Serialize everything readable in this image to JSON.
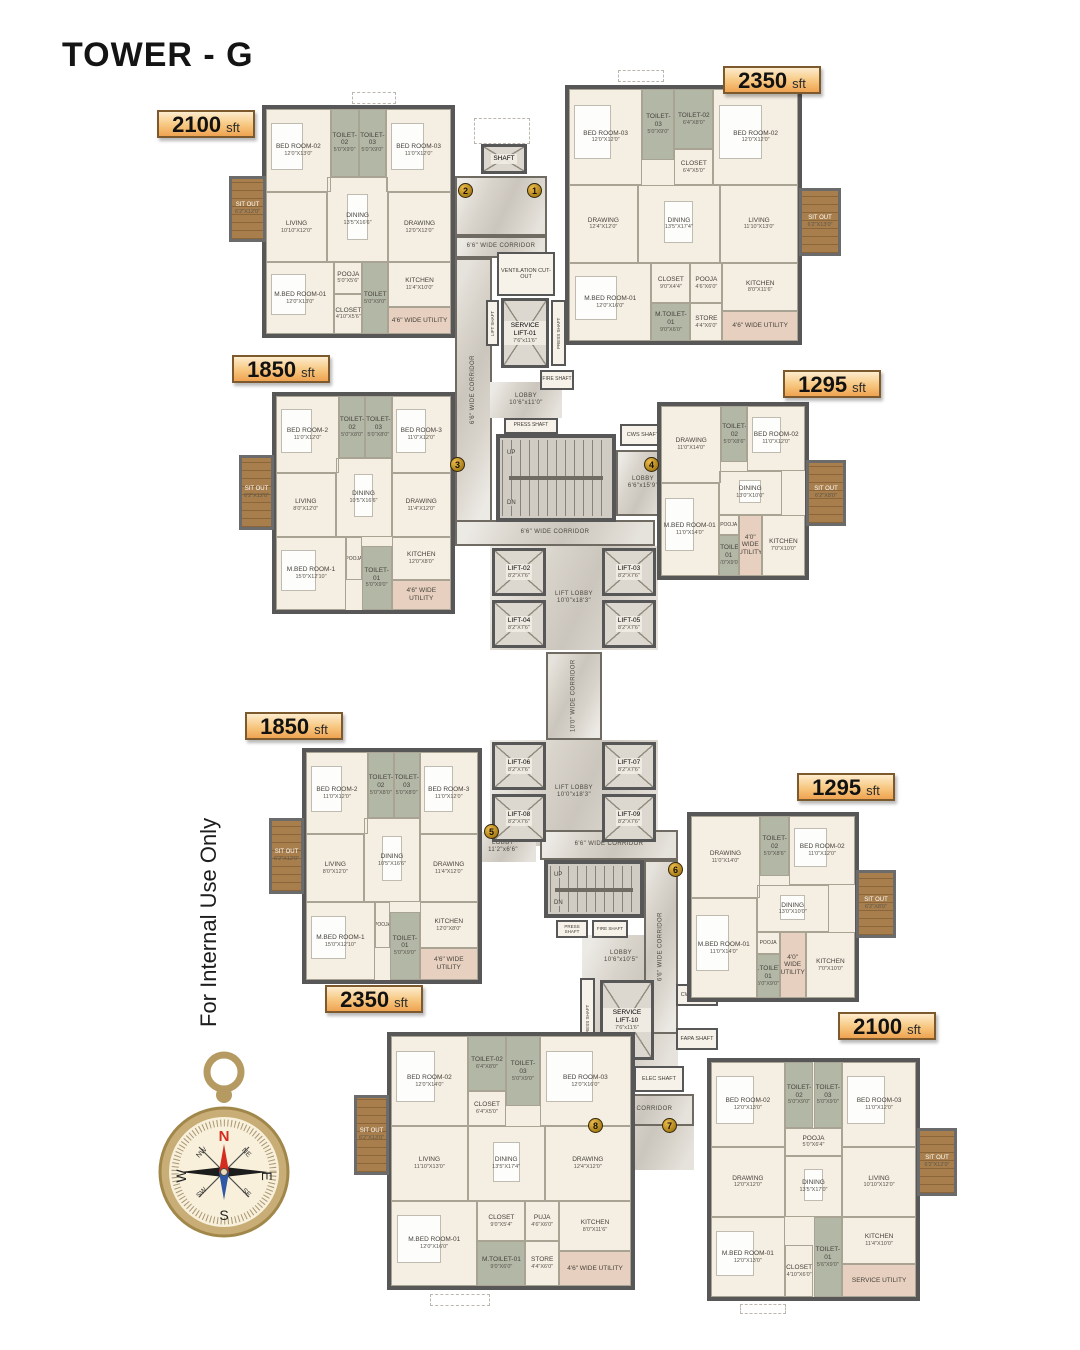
{
  "title": "TOWER - G",
  "watermark": "For Internal Use Only",
  "compass": {
    "n": "N",
    "e": "E",
    "s": "S",
    "w": "W",
    "ne": "NE",
    "nw": "NW",
    "se": "SE",
    "sw": "SW"
  },
  "badges": [
    "1",
    "2",
    "3",
    "4",
    "5",
    "6",
    "7",
    "8"
  ],
  "area_labels": [
    {
      "value": "2100",
      "unit": "sft"
    },
    {
      "value": "2350",
      "unit": "sft"
    },
    {
      "value": "1850",
      "unit": "sft"
    },
    {
      "value": "1295",
      "unit": "sft"
    },
    {
      "value": "1850",
      "unit": "sft"
    },
    {
      "value": "1295",
      "unit": "sft"
    },
    {
      "value": "2350",
      "unit": "sft"
    },
    {
      "value": "2100",
      "unit": "sft"
    }
  ],
  "core": {
    "shaft_top": "SHAFT",
    "corridor_66": "6'6\" WIDE CORRIDOR",
    "corridor_100": "10'0\" WIDE CORRIDOR",
    "ventilation": "VENTILATION CUT-OUT",
    "lift_shaft": "LIFT SHAFT",
    "press_shaft": "PRESS SHAFT",
    "fire_shaft": "FIRE SHAFT",
    "cws_shaft": "CWS SHAFT",
    "fapa_shaft": "FAPA SHAFT",
    "com_shaft": "COM SHAFT",
    "elec_shaft": "ELEC SHAFT",
    "stairs_up": "UP",
    "stairs_dn": "DN",
    "service_lift_01": {
      "n": "SERVICE LIFT-01",
      "d": "7'6\"x11'6\""
    },
    "service_lift_10": {
      "n": "SERVICE LIFT-10",
      "d": "7'6\"x11'6\""
    },
    "lobby_entry": {
      "n": "LOBBY",
      "d": "10'6\"x11'0\""
    },
    "lobby_mid": {
      "n": "LOBBY",
      "d": "6'6\"x15'9\""
    },
    "lobby_low": {
      "n": "LOBBY",
      "d": "11'2\"x6'6\""
    },
    "lobby_bottom": {
      "n": "LOBBY",
      "d": "10'6\"x10'5\""
    },
    "lift_lobby": {
      "n": "LIFT LOBBY",
      "d": "10'0\"x18'3\""
    },
    "lifts": [
      {
        "n": "LIFT-02",
        "d": "8'2\"X7'6\""
      },
      {
        "n": "LIFT-03",
        "d": "8'2\"X7'6\""
      },
      {
        "n": "LIFT-04",
        "d": "8'2\"X7'6\""
      },
      {
        "n": "LIFT-05",
        "d": "8'2\"X7'6\""
      },
      {
        "n": "LIFT-06",
        "d": "8'2\"X7'6\""
      },
      {
        "n": "LIFT-07",
        "d": "8'2\"X7'6\""
      },
      {
        "n": "LIFT-08",
        "d": "8'2\"X7'6\""
      },
      {
        "n": "LIFT-09",
        "d": "8'2\"X7'6\""
      }
    ]
  },
  "units": [
    {
      "id": "unit-2100-top-left",
      "area": "2100 sft",
      "badge": "2",
      "rooms": [
        {
          "n": "BED ROOM-02",
          "d": "12'0\"X13'0\""
        },
        {
          "n": "TOILET-02",
          "d": "5'0\"X9'0\""
        },
        {
          "n": "TOILET-03",
          "d": "5'0\"X9'0\""
        },
        {
          "n": "BED ROOM-03",
          "d": "11'0\"X12'0\""
        },
        {
          "n": "LIVING",
          "d": "10'10\"X12'0\""
        },
        {
          "n": "DINING",
          "d": "13'5\"X16'6\""
        },
        {
          "n": "DRAWING",
          "d": "12'0\"X12'0\""
        },
        {
          "n": "M.BED ROOM-01",
          "d": "12'0\"X13'0\""
        },
        {
          "n": "POOJA",
          "d": "5'0\"X5'6\""
        },
        {
          "n": "CLOSET",
          "d": "4'10\"X5'6\""
        },
        {
          "n": "TOILET",
          "d": "5'0\"X9'0\""
        },
        {
          "n": "KITCHEN",
          "d": "11'4\"X10'0\""
        },
        {
          "n": "4'6\" WIDE UTILITY",
          "d": ""
        },
        {
          "n": "SIT OUT",
          "d": "6'2\"X12'0\""
        }
      ]
    },
    {
      "id": "unit-2350-top-right",
      "area": "2350 sft",
      "badge": "1",
      "rooms": [
        {
          "n": "BED ROOM-03",
          "d": "12'0\"X12'0\""
        },
        {
          "n": "TOILET-03",
          "d": "5'0\"X9'0\""
        },
        {
          "n": "TOILET-02",
          "d": "6'4\"X8'0\""
        },
        {
          "n": "CLOSET",
          "d": "6'4\"X5'0\""
        },
        {
          "n": "BED ROOM-02",
          "d": "12'0\"X12'0\""
        },
        {
          "n": "DRAWING",
          "d": "12'4\"X12'0\""
        },
        {
          "n": "DINING",
          "d": "13'5\"X17'4\""
        },
        {
          "n": "LIVING",
          "d": "11'10\"X13'0\""
        },
        {
          "n": "M.BED ROOM-01",
          "d": "12'0\"X16'0\""
        },
        {
          "n": "CLOSET",
          "d": "9'0\"X4'4\""
        },
        {
          "n": "M.TOILET-01",
          "d": "9'0\"X6'0\""
        },
        {
          "n": "POOJA",
          "d": "4'6\"X6'0\""
        },
        {
          "n": "STORE",
          "d": "4'4\"X6'0\""
        },
        {
          "n": "KITCHEN",
          "d": "8'0\"X11'6\""
        },
        {
          "n": "4'6\" WIDE UTILITY",
          "d": ""
        },
        {
          "n": "SIT OUT",
          "d": "6'2\"X13'0\""
        }
      ]
    },
    {
      "id": "unit-1850-mid-left",
      "area": "1850 sft",
      "badge": "3",
      "rooms": [
        {
          "n": "BED ROOM-2",
          "d": "11'0\"X12'0\""
        },
        {
          "n": "TOILET-02",
          "d": "5'0\"X8'0\""
        },
        {
          "n": "TOILET-03",
          "d": "5'0\"X8'0\""
        },
        {
          "n": "BED ROOM-3",
          "d": "11'0\"X12'0\""
        },
        {
          "n": "LIVING",
          "d": "8'0\"X12'0\""
        },
        {
          "n": "DINING",
          "d": "10'5\"X16'6\""
        },
        {
          "n": "DRAWING",
          "d": "11'4\"X12'0\""
        },
        {
          "n": "M.BED ROOM-1",
          "d": "15'0\"X12'10\""
        },
        {
          "n": "POOJA",
          "d": ""
        },
        {
          "n": "TOILET-01",
          "d": "5'0\"X9'0\""
        },
        {
          "n": "KITCHEN",
          "d": "12'0\"X8'0\""
        },
        {
          "n": "4'6\" WIDE UTILITY",
          "d": ""
        },
        {
          "n": "SIT OUT",
          "d": "6'2\"X12'0\""
        }
      ]
    },
    {
      "id": "unit-1295-mid-right",
      "area": "1295 sft",
      "badge": "4",
      "rooms": [
        {
          "n": "DRAWING",
          "d": "11'0\"X14'0\""
        },
        {
          "n": "TOILET-02",
          "d": "5'0\"X8'6\""
        },
        {
          "n": "BED ROOM-02",
          "d": "11'0\"X12'0\""
        },
        {
          "n": "DINING",
          "d": "13'0\"X10'0\""
        },
        {
          "n": "M.BED ROOM-01",
          "d": "11'0\"X14'0\""
        },
        {
          "n": "POOJA",
          "d": ""
        },
        {
          "n": "M.TOILET-01",
          "d": "5'0\"X9'0\""
        },
        {
          "n": "4'0\" WIDE UTILITY",
          "d": ""
        },
        {
          "n": "KITCHEN",
          "d": "7'0\"X10'0\""
        },
        {
          "n": "SIT OUT",
          "d": "6'2\"X8'0\""
        }
      ]
    },
    {
      "id": "unit-1850-low-left",
      "area": "1850 sft",
      "badge": "5",
      "rooms": [
        {
          "n": "BED ROOM-2",
          "d": "11'0\"X12'0\""
        },
        {
          "n": "TOILET-02",
          "d": "5'0\"X8'0\""
        },
        {
          "n": "TOILET-03",
          "d": "5'0\"X8'0\""
        },
        {
          "n": "BED ROOM-3",
          "d": "11'0\"X12'0\""
        },
        {
          "n": "LIVING",
          "d": "8'0\"X12'0\""
        },
        {
          "n": "DINING",
          "d": "10'5\"X16'6\""
        },
        {
          "n": "DRAWING",
          "d": "11'4\"X12'0\""
        },
        {
          "n": "M.BED ROOM-1",
          "d": "15'0\"X12'10\""
        },
        {
          "n": "POOJA",
          "d": ""
        },
        {
          "n": "TOILET-01",
          "d": "5'0\"X9'0\""
        },
        {
          "n": "KITCHEN",
          "d": "12'0\"X8'0\""
        },
        {
          "n": "4'6\" WIDE UTILITY",
          "d": ""
        },
        {
          "n": "SIT OUT",
          "d": "6'2\"X12'0\""
        }
      ]
    },
    {
      "id": "unit-1295-low-right",
      "area": "1295 sft",
      "badge": "6",
      "rooms": [
        {
          "n": "DRAWING",
          "d": "11'0\"X14'0\""
        },
        {
          "n": "TOILET-02",
          "d": "5'0\"X8'6\""
        },
        {
          "n": "BED ROOM-02",
          "d": "11'0\"X12'0\""
        },
        {
          "n": "DINING",
          "d": "13'0\"X10'0\""
        },
        {
          "n": "M.BED ROOM-01",
          "d": "11'0\"X14'0\""
        },
        {
          "n": "POOJA",
          "d": ""
        },
        {
          "n": "M.TOILET-01",
          "d": "5'0\"X9'0\""
        },
        {
          "n": "4'0\" WIDE UTILITY",
          "d": ""
        },
        {
          "n": "KITCHEN",
          "d": "7'0\"X10'0\""
        },
        {
          "n": "SIT OUT",
          "d": "6'2\"X8'0\""
        }
      ]
    },
    {
      "id": "unit-2350-bottom-left",
      "area": "2350 sft",
      "badge": "8",
      "rooms": [
        {
          "n": "BED ROOM-02",
          "d": "12'0\"X14'0\""
        },
        {
          "n": "TOILET-02",
          "d": "6'4\"X8'0\""
        },
        {
          "n": "CLOSET",
          "d": "6'4\"X5'0\""
        },
        {
          "n": "TOILET-03",
          "d": "5'0\"X9'0\""
        },
        {
          "n": "BED ROOM-03",
          "d": "12'0\"X16'0\""
        },
        {
          "n": "LIVING",
          "d": "11'10\"X13'0\""
        },
        {
          "n": "DINING",
          "d": "13'5\"X17'4\""
        },
        {
          "n": "DRAWING",
          "d": "12'4\"X12'0\""
        },
        {
          "n": "M.BED ROOM-01",
          "d": "12'0\"X16'0\""
        },
        {
          "n": "CLOSET",
          "d": "9'0\"X5'4\""
        },
        {
          "n": "M.TOILET-01",
          "d": "9'0\"X6'0\""
        },
        {
          "n": "PUJA",
          "d": "4'6\"X6'0\""
        },
        {
          "n": "STORE",
          "d": "4'4\"X6'0\""
        },
        {
          "n": "KITCHEN",
          "d": "8'0\"X11'6\""
        },
        {
          "n": "4'6\" WIDE UTILITY",
          "d": ""
        },
        {
          "n": "SIT OUT",
          "d": "6'2\"X13'0\""
        }
      ]
    },
    {
      "id": "unit-2100-bottom-right",
      "area": "2100 sft",
      "badge": "7",
      "rooms": [
        {
          "n": "BED ROOM-02",
          "d": "12'0\"X13'0\""
        },
        {
          "n": "TOILET-02",
          "d": "5'0\"X9'0\""
        },
        {
          "n": "TOILET-03",
          "d": "5'0\"X9'0\""
        },
        {
          "n": "POOJA",
          "d": "5'0\"X6'4\""
        },
        {
          "n": "BED ROOM-03",
          "d": "11'0\"X12'0\""
        },
        {
          "n": "DRAWING",
          "d": "12'0\"X12'0\""
        },
        {
          "n": "DINING",
          "d": "13'5\"X17'0\""
        },
        {
          "n": "LIVING",
          "d": "10'10\"X12'0\""
        },
        {
          "n": "M.BED ROOM-01",
          "d": "12'0\"X13'0\""
        },
        {
          "n": "CLOSET",
          "d": "4'10\"X6'0\""
        },
        {
          "n": "TOILET-01",
          "d": "5'6\"X9'0\""
        },
        {
          "n": "KITCHEN",
          "d": "11'4\"X10'0\""
        },
        {
          "n": "SERVICE UTILITY",
          "d": ""
        },
        {
          "n": "SIT OUT",
          "d": "6'2\"X12'0\""
        }
      ]
    }
  ],
  "colors": {
    "label_accent": "#efa351",
    "wall": "#575757",
    "floor": "#f4eee3",
    "toilet": "#b2b7a6",
    "corridor": "#d9d4cb",
    "wood": "#a87f4c",
    "utility": "#e7d0bf",
    "badge_gold": "#c9930f"
  }
}
